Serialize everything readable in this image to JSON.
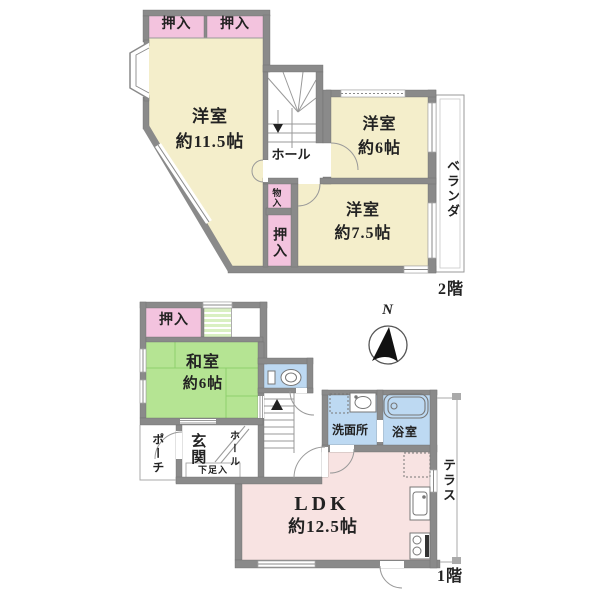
{
  "title": "floor-plan",
  "colors": {
    "wall": "#8a8a8a",
    "room_cream": "#f4eecb",
    "closet_pink": "#f3c3de",
    "tatami_green": "#b5e493",
    "stair_green": "#d9f0c2",
    "wet_blue": "#bdd9f2",
    "ldk_pink": "#f8e3e2"
  },
  "floor2": {
    "label": "2階",
    "closet_top_left": "押入",
    "closet_top_right": "押入",
    "room_115": {
      "name": "洋室",
      "size": "約11.5帖"
    },
    "room_6": {
      "name": "洋室",
      "size": "約6帖"
    },
    "room_75": {
      "name": "洋室",
      "size": "約7.5帖"
    },
    "hall": "ホール",
    "storage": "物入",
    "closet_side": "押入",
    "veranda": "ベランダ"
  },
  "floor1": {
    "label": "1階",
    "closet": "押入",
    "washitsu": {
      "name": "和室",
      "size": "約6帖"
    },
    "porch": "ポーチ",
    "entrance": "玄関",
    "shoe_box": "下足入",
    "hall": "ホール",
    "washroom": "洗面所",
    "bathroom": "浴室",
    "ldk": {
      "name": "LDK",
      "size": "約12.5帖"
    },
    "terrace": "テラス"
  },
  "compass": {
    "north": "N"
  }
}
